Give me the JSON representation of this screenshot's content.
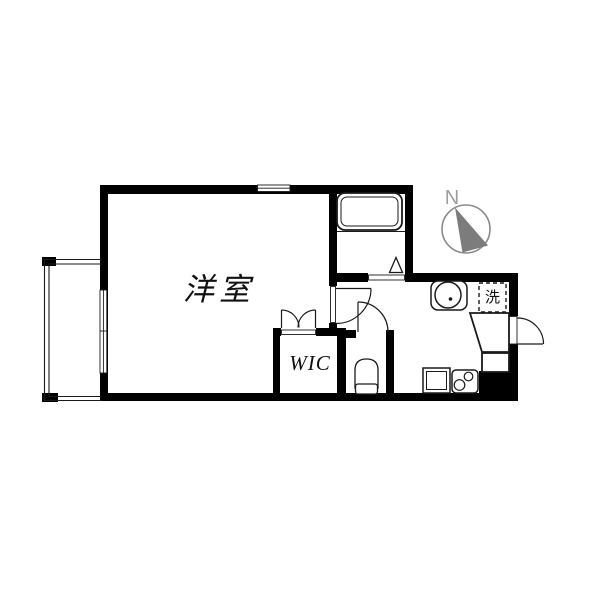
{
  "floor_plan": {
    "labels": {
      "main_room": "洋室",
      "walk_in_closet": "WIC",
      "laundry_space": "洗",
      "compass_north": "N"
    },
    "colors": {
      "wall": "#000000",
      "line": "#1a1a1a",
      "compass_gray": "#8a8a8a",
      "compass_text": "#9e9e9e",
      "background": "#ffffff"
    },
    "icons": [
      "bathtub-icon",
      "folding-door-icon",
      "door-swing-icon",
      "double-door-icon",
      "washbasin-icon",
      "toilet-icon",
      "kitchen-sink-icon",
      "stove-icon",
      "entrance-door-icon",
      "entrance-step-icon",
      "balcony-railing-icon",
      "window-icon",
      "compass-icon",
      "washing-machine-space-icon"
    ]
  }
}
